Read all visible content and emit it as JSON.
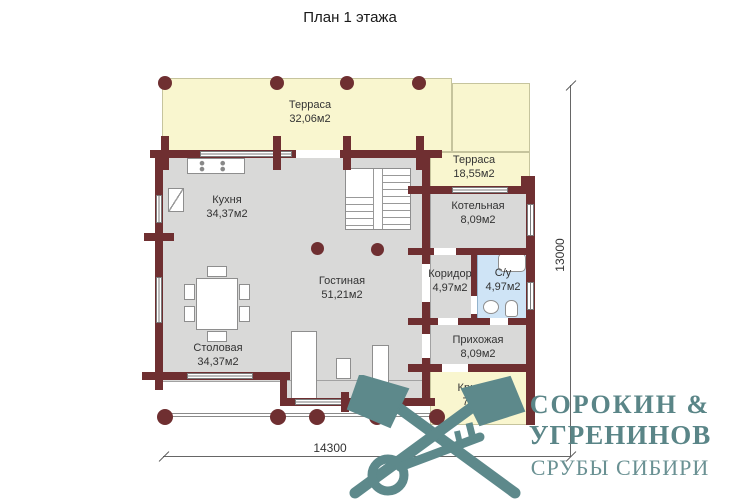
{
  "title": "План 1 этажа",
  "dimensions": {
    "height_label": "13000",
    "width_label": "14300"
  },
  "rooms": [
    {
      "id": "terrace-top",
      "name": "Терраса",
      "area": "32,06м2"
    },
    {
      "id": "terrace-right",
      "name": "Терраса",
      "area": "18,55м2"
    },
    {
      "id": "kitchen",
      "name": "Кухня",
      "area": "34,37м2"
    },
    {
      "id": "boiler",
      "name": "Котельная",
      "area": "8,09м2"
    },
    {
      "id": "living",
      "name": "Гостиная",
      "area": "51,21м2"
    },
    {
      "id": "corridor",
      "name": "Коридор",
      "area": "4,97м2"
    },
    {
      "id": "bathroom",
      "name": "С/у",
      "area": "4,97м2"
    },
    {
      "id": "dining",
      "name": "Столовая",
      "area": "34,37м2"
    },
    {
      "id": "hallway",
      "name": "Прихожая",
      "area": "8,09м2"
    },
    {
      "id": "porch",
      "name": "Крыльцо",
      "area": "7,04м2"
    }
  ],
  "logo": {
    "line1": "СОРОКИН &",
    "line2": "УГРЕНИНОВ",
    "line3": "СРУБЫ СИБИРИ"
  },
  "colors": {
    "wall": "#6f2f31",
    "terrace": "#f9f6cf",
    "room_gray": "#d9d9d8",
    "bathroom_blue": "#cfe4f6",
    "logo_teal": "#5d898b"
  }
}
